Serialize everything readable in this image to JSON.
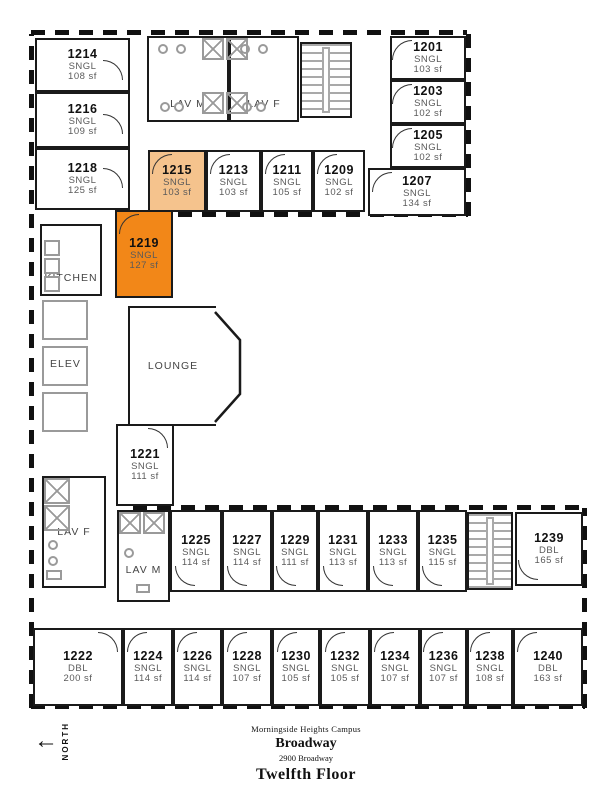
{
  "title_block": {
    "campus": "Morningside Heights Campus",
    "building": "Broadway",
    "address": "2900 Broadway",
    "floor": "Twelfth Floor"
  },
  "compass": {
    "label": "NORTH"
  },
  "colors": {
    "highlight_primary": "#F28718",
    "highlight_secondary": "#F5C38D"
  },
  "common_areas": {
    "lav_m_top": "LAV M",
    "lav_f_top": "LAV F",
    "kitchen": "KITCHEN",
    "elevator": "ELEV",
    "lounge": "LOUNGE",
    "lav_f_left": "LAV F",
    "lav_m_lower": "LAV M"
  },
  "rooms": [
    {
      "number": "1214",
      "type": "SNGL",
      "area": "108 sf"
    },
    {
      "number": "1216",
      "type": "SNGL",
      "area": "109 sf"
    },
    {
      "number": "1218",
      "type": "SNGL",
      "area": "125 sf"
    },
    {
      "number": "1201",
      "type": "SNGL",
      "area": "103 sf"
    },
    {
      "number": "1203",
      "type": "SNGL",
      "area": "102 sf"
    },
    {
      "number": "1205",
      "type": "SNGL",
      "area": "102 sf"
    },
    {
      "number": "1207",
      "type": "SNGL",
      "area": "134 sf"
    },
    {
      "number": "1215",
      "type": "SNGL",
      "area": "103 sf",
      "highlight": "secondary"
    },
    {
      "number": "1213",
      "type": "SNGL",
      "area": "103 sf"
    },
    {
      "number": "1211",
      "type": "SNGL",
      "area": "105 sf"
    },
    {
      "number": "1209",
      "type": "SNGL",
      "area": "102 sf"
    },
    {
      "number": "1219",
      "type": "SNGL",
      "area": "127 sf",
      "highlight": "primary"
    },
    {
      "number": "1221",
      "type": "SNGL",
      "area": "111 sf"
    },
    {
      "number": "1225",
      "type": "SNGL",
      "area": "114 sf"
    },
    {
      "number": "1227",
      "type": "SNGL",
      "area": "114 sf"
    },
    {
      "number": "1229",
      "type": "SNGL",
      "area": "111 sf"
    },
    {
      "number": "1231",
      "type": "SNGL",
      "area": "113 sf"
    },
    {
      "number": "1233",
      "type": "SNGL",
      "area": "113 sf"
    },
    {
      "number": "1235",
      "type": "SNGL",
      "area": "115 sf"
    },
    {
      "number": "1239",
      "type": "DBL",
      "area": "165 sf"
    },
    {
      "number": "1222",
      "type": "DBL",
      "area": "200 sf"
    },
    {
      "number": "1224",
      "type": "SNGL",
      "area": "114 sf"
    },
    {
      "number": "1226",
      "type": "SNGL",
      "area": "114 sf"
    },
    {
      "number": "1228",
      "type": "SNGL",
      "area": "107 sf"
    },
    {
      "number": "1230",
      "type": "SNGL",
      "area": "105 sf"
    },
    {
      "number": "1232",
      "type": "SNGL",
      "area": "105 sf"
    },
    {
      "number": "1234",
      "type": "SNGL",
      "area": "107 sf"
    },
    {
      "number": "1236",
      "type": "SNGL",
      "area": "107 sf"
    },
    {
      "number": "1238",
      "type": "SNGL",
      "area": "108 sf"
    },
    {
      "number": "1240",
      "type": "DBL",
      "area": "163 sf"
    }
  ]
}
